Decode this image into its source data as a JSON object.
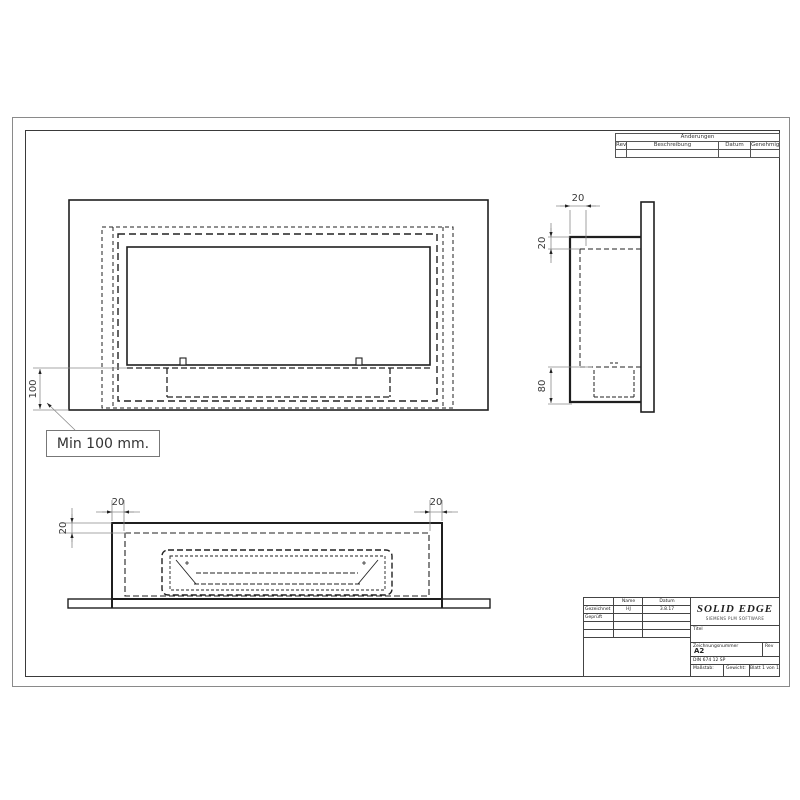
{
  "colors": {
    "line": "#1f1f1f",
    "dimension": "#8a8a8a",
    "text": "#333333"
  },
  "revision_table": {
    "title": "Änderungen",
    "col_rev": "Rev",
    "col_desc": "Beschreibung",
    "col_date": "Datum",
    "col_approved": "Genehmigt"
  },
  "title_block": {
    "col_name": "Name",
    "col_date": "Datum",
    "row_drawn_label": "Gezeichnet",
    "row_drawn_name": "HJ",
    "row_drawn_date": "3.8.17",
    "row_checked_label": "Geprüft",
    "logo_line1": "SOLID EDGE",
    "logo_line2": "SIEMENS PLM SOFTWARE",
    "title_label": "Titel",
    "dwg_no_label": "Zeichnungsnummer",
    "sheet_size": "A2",
    "rev_label": "Rev",
    "file_text": "DIN 674 12 SP",
    "scale_label": "Maßstab:",
    "weight_label": "Gewicht:",
    "sheet_label": "Blatt 1 von 1"
  },
  "callout": {
    "min_note": "Min 100 mm."
  },
  "dims": {
    "front_height": "100",
    "side_depth": "20",
    "side_top": "20",
    "side_burner": "80",
    "plan_left_wall": "20",
    "plan_right_wall": "20",
    "plan_front_wall": "20"
  }
}
